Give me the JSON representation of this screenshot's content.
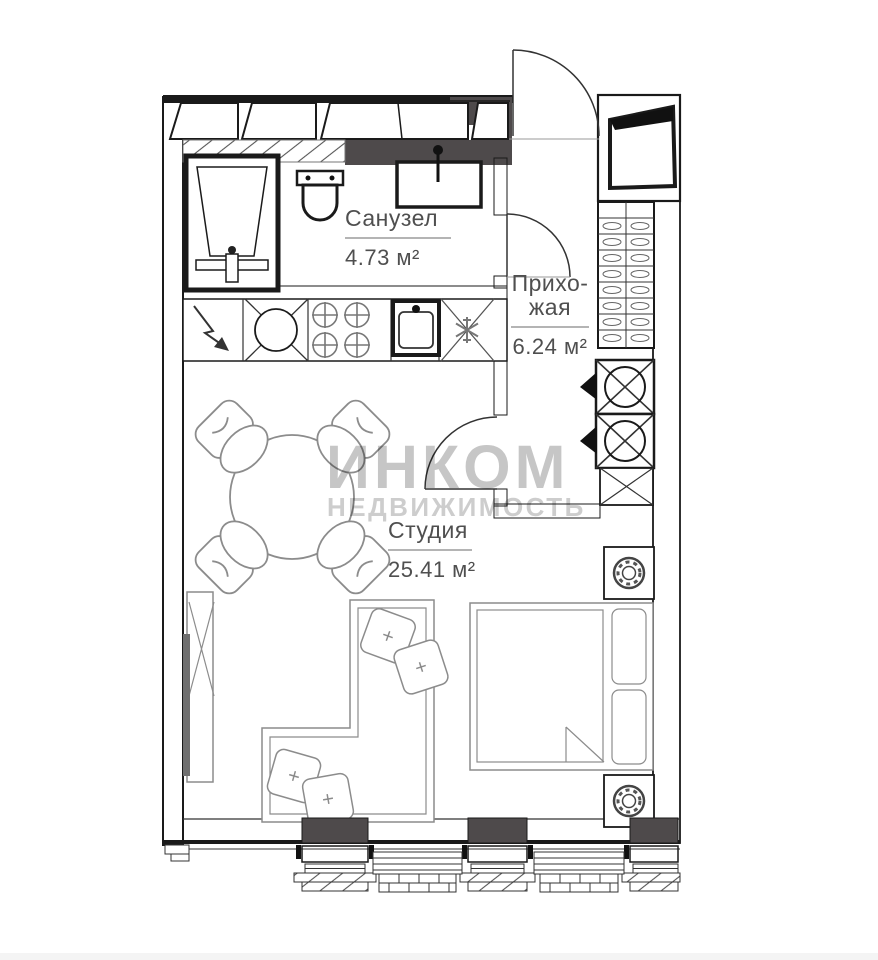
{
  "plan": {
    "rooms": {
      "bathroom": {
        "label": "Санузел",
        "area": "4.73 м²"
      },
      "hallway": {
        "label": "Прихо-\nжая",
        "area": "6.24 м²"
      },
      "studio": {
        "label": "Студия",
        "area": "25.41 м²"
      }
    },
    "watermark": {
      "title": "ИНКОМ",
      "subtitle": "НЕДВИЖИМОСТЬ"
    }
  },
  "colors": {
    "line": "#1a1a1a",
    "furniture_line": "#8c8c8c",
    "dark_fill": "#4e4a4b",
    "label_text": "#4f4f4f",
    "watermark": "#c6c6c6",
    "background": "#ffffff"
  }
}
